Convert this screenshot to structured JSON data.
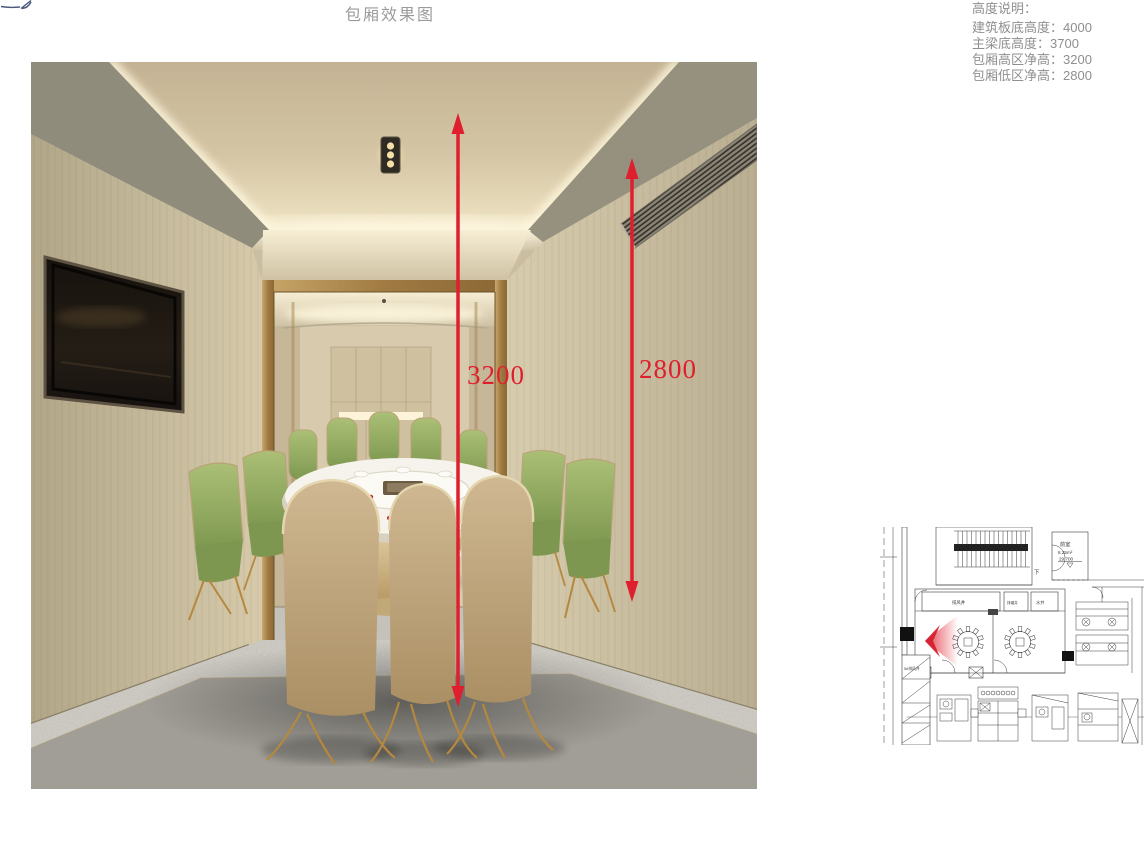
{
  "page": {
    "title": "包厢效果图"
  },
  "notes": {
    "heading": "高度说明：",
    "items": [
      "建筑板底高度：4000",
      "主梁底高度：3700",
      "包厢高区净高：3200",
      "包厢低区净高：2800"
    ]
  },
  "render": {
    "dims": [
      {
        "label": "3200"
      },
      {
        "label": "2800"
      }
    ],
    "accent_color": "#e01f2e"
  },
  "plan": {
    "labels": {
      "anteroom": "前室",
      "anteroom_area": "8.25m²",
      "anteroom_level": "29.700",
      "stair_down": "下",
      "shaft_air": "排风井",
      "shaft_smoke": "排烟井",
      "shaft_water": "水井",
      "shaft_exhaust": "5#排风井"
    }
  }
}
